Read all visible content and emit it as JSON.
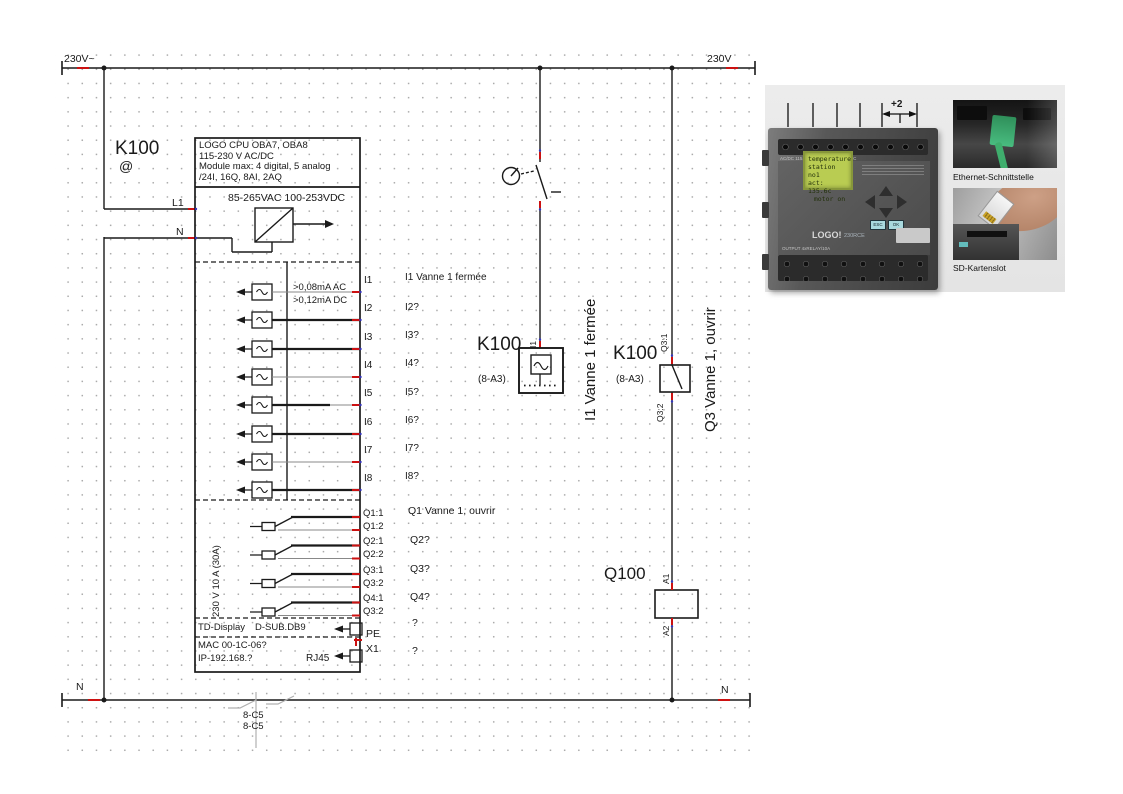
{
  "rails": {
    "top_left": "230V~",
    "top_right": "230V",
    "bottom_left": "N",
    "bottom_right": "N"
  },
  "plc": {
    "tag": "K100",
    "tag_symbol": "@",
    "header": [
      "LOGO CPU OBA7, OBA8",
      "115-230 V AC/DC",
      "Module max: 4 digital, 5 analog",
      "/24I, 16Q, 8AI, 2AQ"
    ],
    "supply": "85-265VAC 100-253VDC",
    "l1": "L1",
    "n": "N",
    "input_note_ac": ">0,08mA AC",
    "input_note_dc": ">0,12mA DC",
    "inputs": [
      {
        "terminal": "I1",
        "text": "I1 Vanne 1 fermée"
      },
      {
        "terminal": "I2",
        "text": "I2?"
      },
      {
        "terminal": "I3",
        "text": "I3?"
      },
      {
        "terminal": "I4",
        "text": "I4?"
      },
      {
        "terminal": "I5",
        "text": "I5?"
      },
      {
        "terminal": "I6",
        "text": "I6?"
      },
      {
        "terminal": "I7",
        "text": "I7?"
      },
      {
        "terminal": "I8",
        "text": "I8?"
      }
    ],
    "output_rating": "230 V 10 A (30A)",
    "output_terminals": [
      "Q1:1",
      "Q1:2",
      "Q2:1",
      "Q2:2",
      "Q3:1",
      "Q3:2",
      "Q4:1",
      "Q3:2"
    ],
    "output_texts": [
      "Q1 Vanne 1, ouvrir",
      "Q2?",
      "Q3?",
      "Q4?"
    ],
    "pe_terminal": "PE",
    "pe_text": "?",
    "x1_terminal": "X1",
    "x1_text": "?",
    "td_display": "TD-Display",
    "dsub": "D-SUB.DB9",
    "mac": "MAC 00-1C-06?",
    "ip": "IP-192.168.?",
    "rj45": "RJ45"
  },
  "branch_i1": {
    "tag": "K100",
    "ref": "(8-A3)",
    "terminal": "I1",
    "wire_text": "I1 Vanne 1 fermée"
  },
  "branch_q3": {
    "tag": "K100",
    "ref": "(8-A3)",
    "terminal_top": "Q3:1",
    "terminal_bottom": "Q3:2",
    "wire_text": "Q3 Vanne 1, ouvrir"
  },
  "relay": {
    "tag": "Q100",
    "a1": "A1",
    "a2": "A2"
  },
  "cross_refs": [
    "8-C5",
    "8-C5"
  ],
  "photo": {
    "dim_label": "+2",
    "brand": "SIEMENS",
    "lcd_lines": [
      "temperature",
      "station no1",
      "act: 135.6c",
      "motor on"
    ],
    "model": "LOGO!",
    "model_suffix": "230RCE",
    "btn_esc": "ESC",
    "btn_ok": "OK",
    "print_top": "AC/DC 115..240V      INPUT 8xAC/DC",
    "print_bottom": "OUTPUT 4xRELAY/10A",
    "caption_ethernet": "Ethernet-Schnittstelle",
    "caption_sd": "SD-Kartenslot"
  },
  "colors": {
    "wire": "#1a1a1a",
    "accent_red": "#cc1111",
    "accent_blue": "#3434bb",
    "lcd_green": "#b9cc52"
  }
}
